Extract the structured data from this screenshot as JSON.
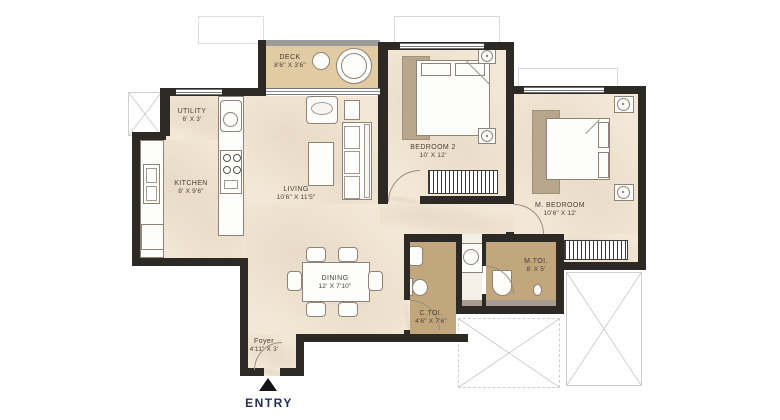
{
  "rooms": {
    "deck": {
      "name": "DECK",
      "dims": "8'6\" X 3'6\""
    },
    "utility": {
      "name": "UTILITY",
      "dims": "6' X 3'"
    },
    "kitchen": {
      "name": "KITCHEN",
      "dims": "8' X 9'6\""
    },
    "living": {
      "name": "LIVING",
      "dims": "10'6\" X 11'5\""
    },
    "bedroom2": {
      "name": "BEDROOM 2",
      "dims": "10' X 12'"
    },
    "m_bedroom": {
      "name": "M. BEDROOM",
      "dims": "10'6\" X 12'"
    },
    "dining": {
      "name": "DINING",
      "dims": "12' X 7'10\""
    },
    "c_toi": {
      "name": "C.TOI.",
      "dims": "4'6\" X 7'6\""
    },
    "m_toi": {
      "name": "M.TOI.",
      "dims": "8' X 5'"
    },
    "foyer": {
      "name": "Foyer",
      "dims": "4'11\" X 3'"
    }
  },
  "entry": {
    "label": "ENTRY",
    "icon": "triangle-up"
  },
  "colors": {
    "wall": "#2d2925",
    "floor_cream": "#f3e8d7",
    "toilet_tan": "#c2a77d",
    "deck_tan": "#e0cba2",
    "rug": "#b7a68c",
    "label_text": "#4a4137",
    "entry_text": "#233050",
    "terrace_line": "#c4c4c4"
  }
}
